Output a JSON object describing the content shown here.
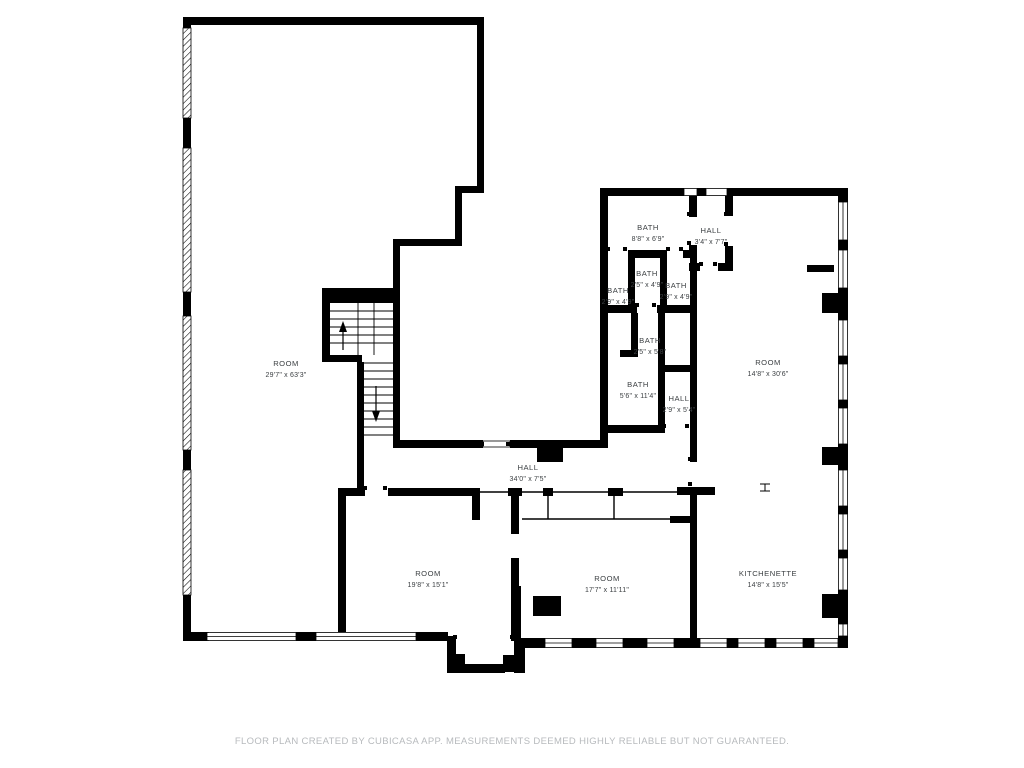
{
  "page": {
    "title": "Floor plan",
    "footer": "FLOOR PLAN CREATED BY CUBICASA APP. MEASUREMENTS DEEMED HIGHLY RELIABLE BUT NOT GUARANTEED."
  },
  "colors": {
    "wall": "#000000",
    "label_text": "#3c4043",
    "footer_text": "#b7babd",
    "background": "#ffffff"
  },
  "icons": {
    "stair_up": "arrow-up",
    "stair_down": "arrow-down",
    "door_opening": "wall-gap",
    "window": "double-line-window"
  },
  "rooms": [
    {
      "id": "room-large",
      "name": "ROOM",
      "dims": "29'7\" x 63'3\""
    },
    {
      "id": "bath-top",
      "name": "BATH",
      "dims": "8'8\" x 6'9\""
    },
    {
      "id": "hall-top",
      "name": "HALL",
      "dims": "3'4\" x 7'7\""
    },
    {
      "id": "bath-small-left",
      "name": "BATH",
      "dims": "2'9\" x 4'9\""
    },
    {
      "id": "bath-small-mid",
      "name": "BATH",
      "dims": "2'5\" x 4'9\""
    },
    {
      "id": "bath-small-right",
      "name": "BATH",
      "dims": "2'9\" x 4'9\""
    },
    {
      "id": "bath-mid",
      "name": "BATH",
      "dims": "2'5\" x 5'8\""
    },
    {
      "id": "bath-lower",
      "name": "BATH",
      "dims": "5'6\" x 11'4\""
    },
    {
      "id": "hall-small",
      "name": "HALL",
      "dims": "2'9\" x 5'4\""
    },
    {
      "id": "room-right",
      "name": "ROOM",
      "dims": "14'8\" x 30'6\""
    },
    {
      "id": "hall-main",
      "name": "HALL",
      "dims": "34'0\" x 7'5\""
    },
    {
      "id": "room-bottom-left",
      "name": "ROOM",
      "dims": "19'8\" x 15'1\""
    },
    {
      "id": "room-bottom-mid",
      "name": "ROOM",
      "dims": "17'7\" x 11'11\""
    },
    {
      "id": "kitchenette",
      "name": "KITCHENETTE",
      "dims": "14'8\" x 15'5\""
    }
  ]
}
